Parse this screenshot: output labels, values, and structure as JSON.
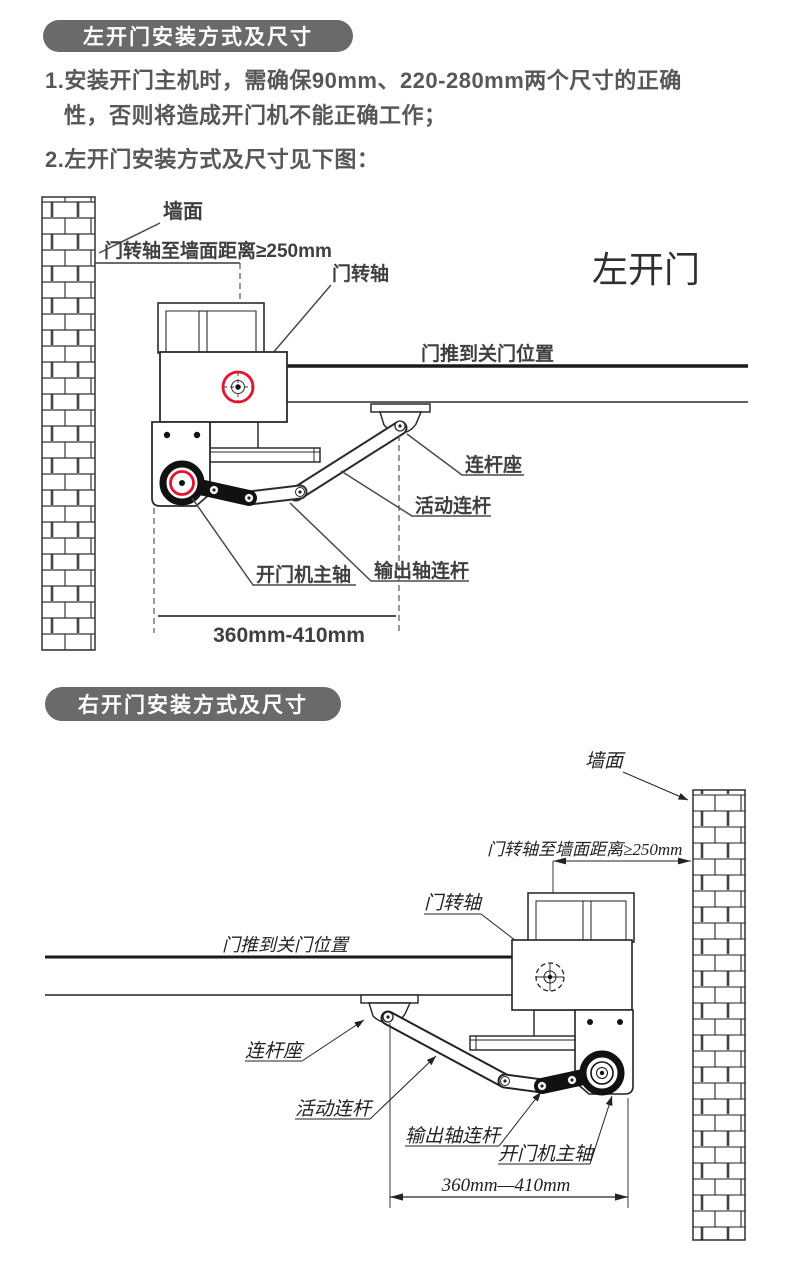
{
  "colors": {
    "badge_bg": "#6a6a6a",
    "badge_text": "#ffffff",
    "body_text": "#575757",
    "line_dark": "#2b2b2b",
    "accent_red": "#e8112d"
  },
  "left_section": {
    "badge_label": "左开门安装方式及尺寸",
    "instr1_line1": "1.安装开门主机时，需确保90mm、220-280mm两个尺寸的正确",
    "instr1_line2": "性，否则将造成开门机不能正确工作；",
    "instr2": "2.左开门安装方式及尺寸见下图：",
    "diagram": {
      "title": "左开门",
      "wall_label": "墙面",
      "pivot_distance_label": "门转轴至墙面距离≥250mm",
      "door_pivot_label": "门转轴",
      "door_closed_label": "门推到关门位置",
      "rod_seat_label": "连杆座",
      "movable_rod_label": "活动连杆",
      "output_rod_label": "输出轴连杆",
      "main_shaft_label": "开门机主轴",
      "dimension_label": "360mm-410mm"
    }
  },
  "right_section": {
    "badge_label": "右开门安装方式及尺寸",
    "diagram": {
      "wall_label": "墙面",
      "pivot_distance_label": "门转轴至墙面距离≥250mm",
      "door_pivot_label": "门转轴",
      "door_closed_label": "门推到关门位置",
      "rod_seat_label": "连杆座",
      "movable_rod_label": "活动连杆",
      "output_rod_label": "输出轴连杆",
      "main_shaft_label": "开门机主轴",
      "dimension_label": "360mm—410mm"
    }
  }
}
